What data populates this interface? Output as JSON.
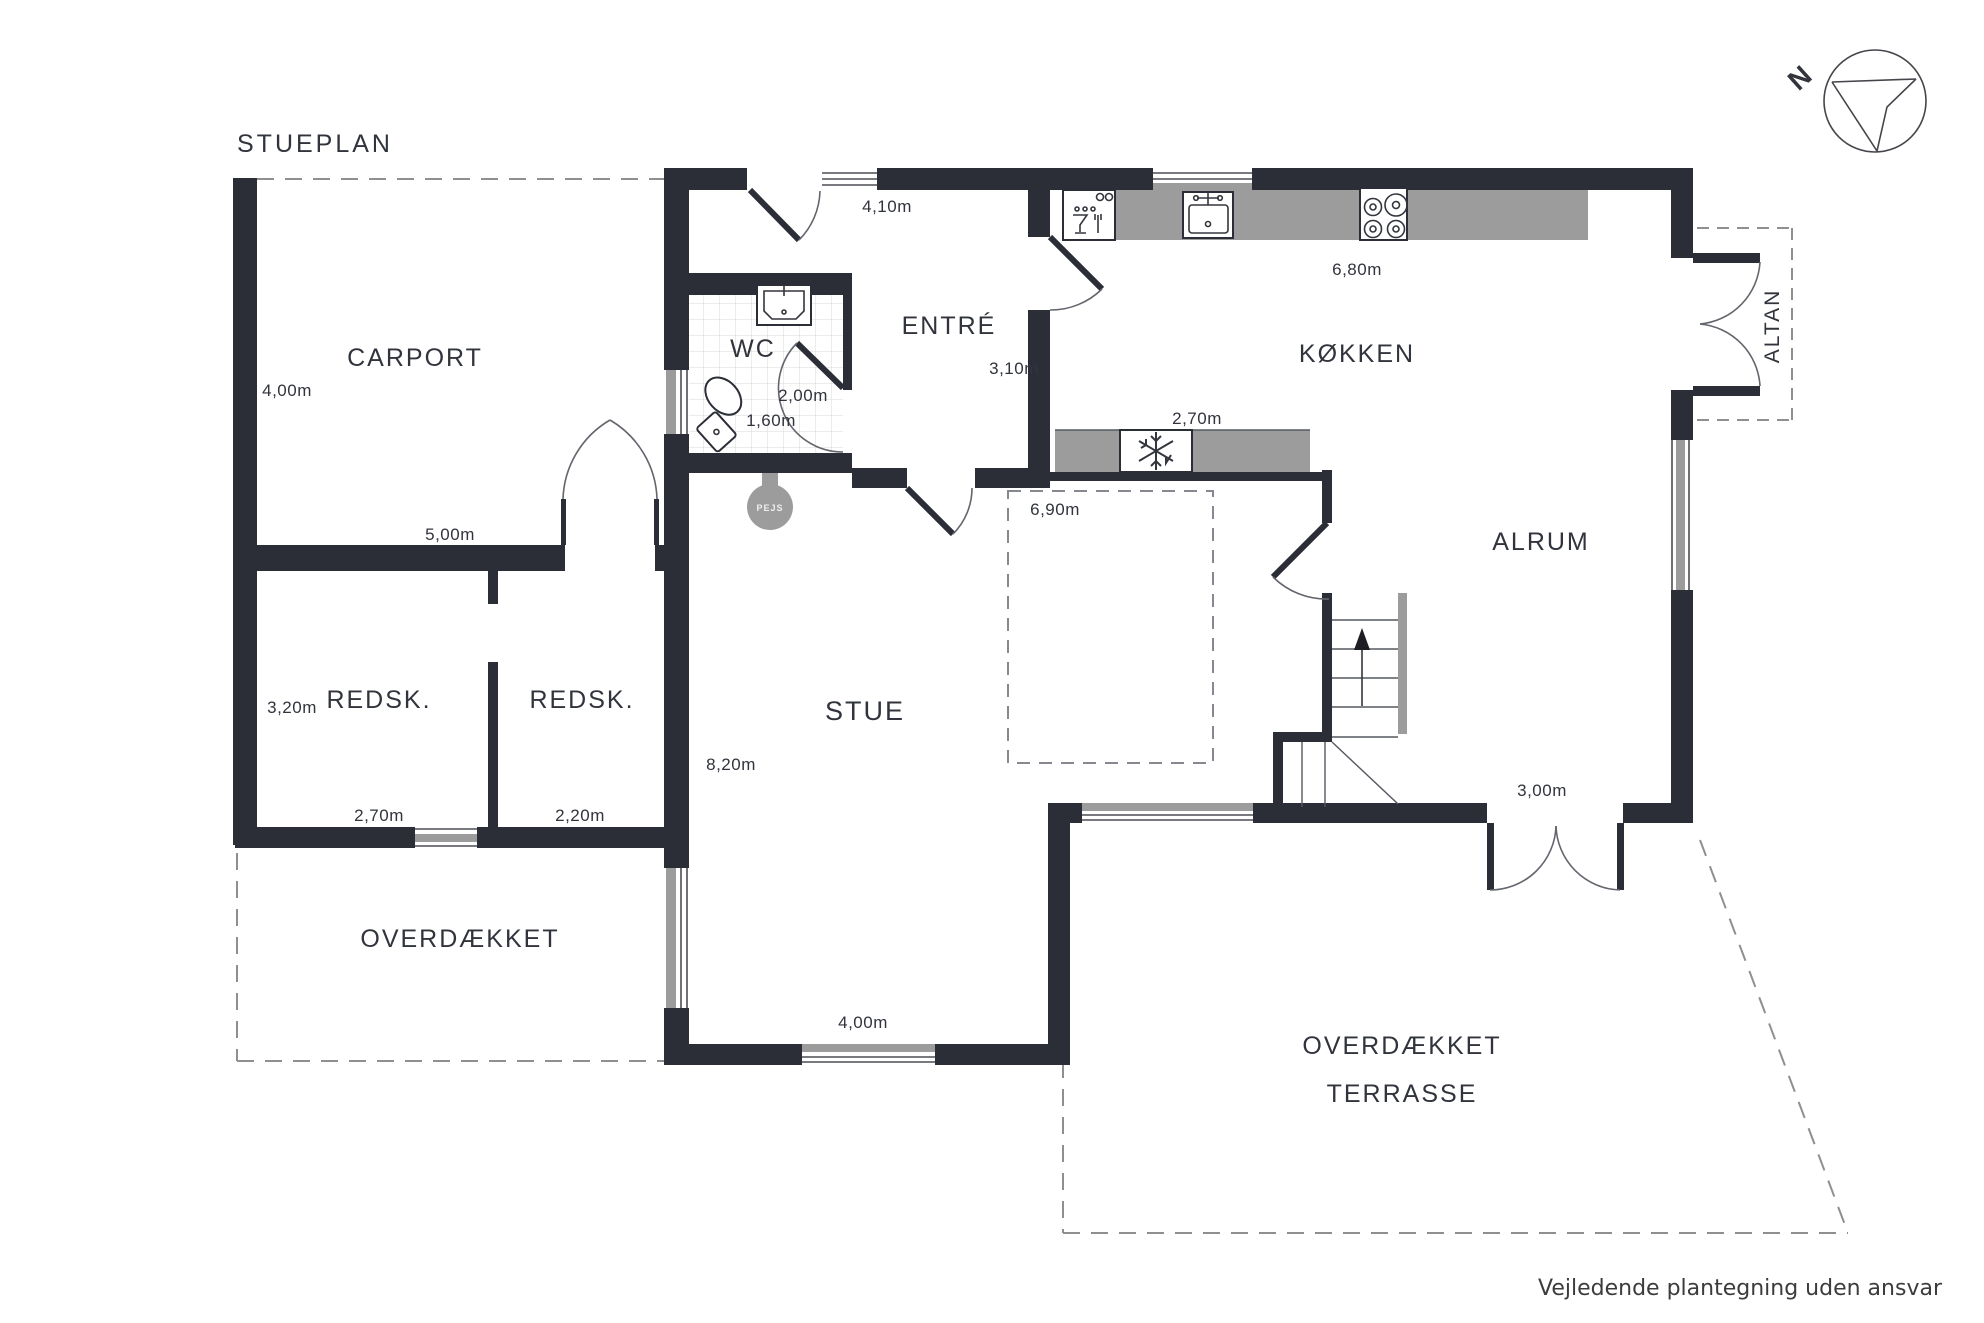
{
  "title": "STUEPLAN",
  "disclaimer": "Vejledende plantegning uden ansvar",
  "compass": {
    "north": "N"
  },
  "colors": {
    "wall": "#2b2e37",
    "counter_gray": "#9c9c9c",
    "text": "#31343c",
    "dashed_line": "#8f8f8f",
    "tile_line": "#d8d8d8"
  },
  "rooms": {
    "carport": {
      "label": "CARPORT",
      "height": "4,00m",
      "width": "5,00m"
    },
    "redsk_left": {
      "label": "REDSK.",
      "height": "3,20m",
      "width": "2,70m"
    },
    "redsk_right": {
      "label": "REDSK.",
      "width": "2,20m"
    },
    "overdaekket": {
      "label": "OVERDÆKKET"
    },
    "wc": {
      "label": "WC",
      "width": "2,00m",
      "depth": "1,60m"
    },
    "entre": {
      "label": "ENTRÉ",
      "entry_width": "4,10m",
      "width": "3,10m"
    },
    "kokken": {
      "label": "KØKKEN",
      "counter_width": "6,80m",
      "island_width": "2,70m"
    },
    "stue": {
      "label": "STUE",
      "height": "8,20m",
      "dining_width": "6,90m",
      "window_width": "4,00m"
    },
    "alrum": {
      "label": "ALRUM",
      "terrace_door_width": "3,00m"
    },
    "altan": {
      "label": "ALTAN"
    },
    "terrasse": {
      "label_line1": "OVERDÆKKET",
      "label_line2": "TERRASSE"
    },
    "pejs": {
      "label": "PEJS"
    }
  }
}
